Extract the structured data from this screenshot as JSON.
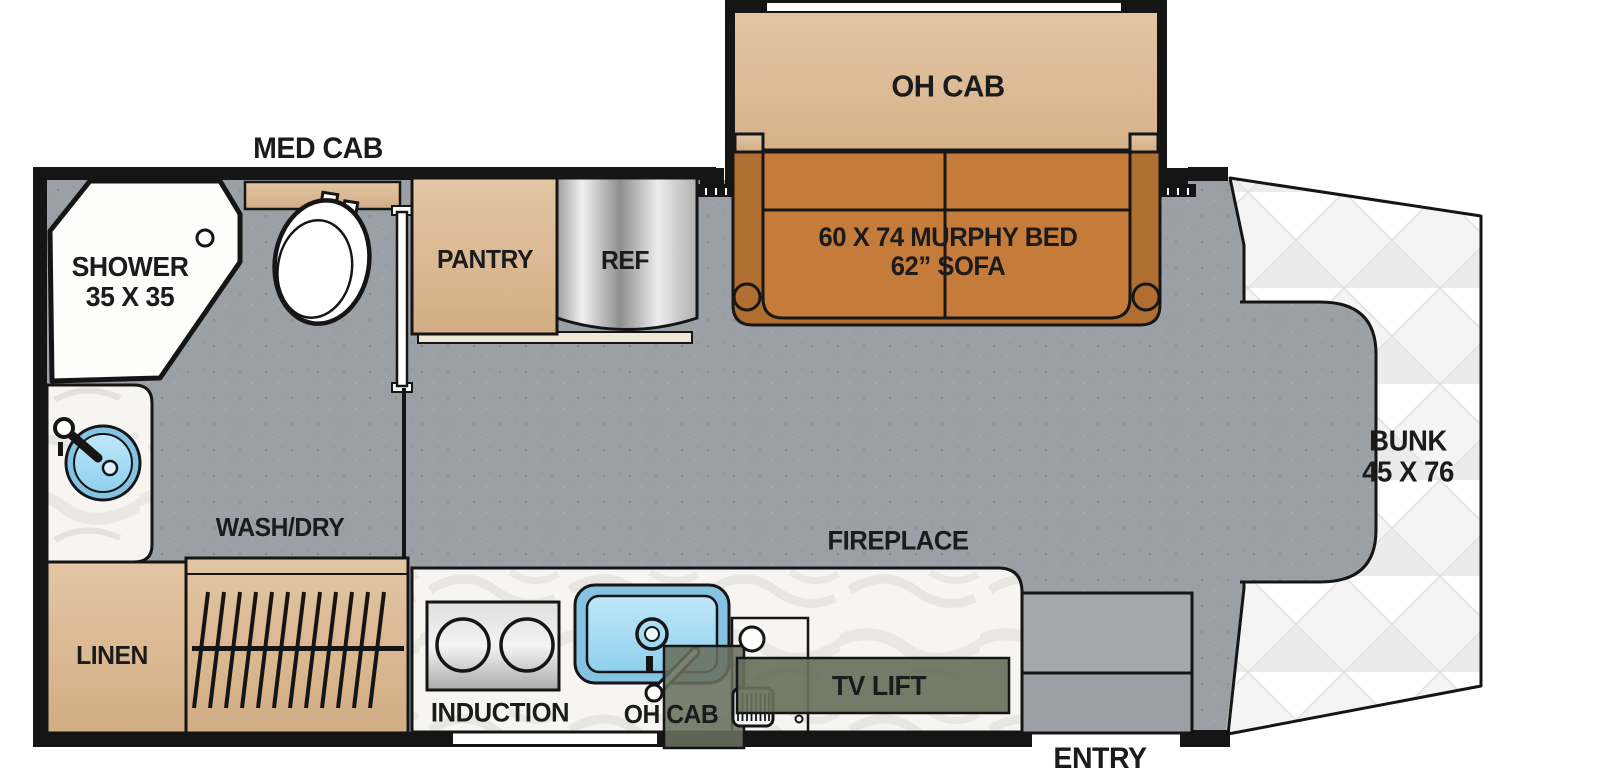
{
  "labels": {
    "med_cab": "MED CAB",
    "shower_line1": "SHOWER",
    "shower_line2": "35 X 35",
    "pantry": "PANTRY",
    "ref": "REF",
    "oh_cab_slideout": "OH CAB",
    "murphy_bed_line1": "60 X 74 MURPHY BED",
    "murphy_bed_line2": "62” SOFA",
    "bunk_line1": "BUNK",
    "bunk_line2": "45 X 76",
    "wash_dry": "WASH/DRY",
    "linen": "LINEN",
    "induction": "INDUCTION",
    "oh_cab_kitchen": "OH CAB",
    "tv_lift": "TV LIFT",
    "fireplace": "FIREPLACE",
    "entry": "ENTRY"
  },
  "colors": {
    "floor_gray": "#9aa0a5",
    "wall_black": "#151515",
    "cabinet_wood": "#dcba94",
    "sofa_orange": "#c57c3a",
    "sofa_frame_brown": "#b06f30",
    "murphy_bed_dark": "#7a4a21",
    "sink_blue": "#84c3e2",
    "appliance_olive": "#68705c",
    "mattress_white": "#fbfbfa",
    "counter_white": "#f6f5f2"
  }
}
